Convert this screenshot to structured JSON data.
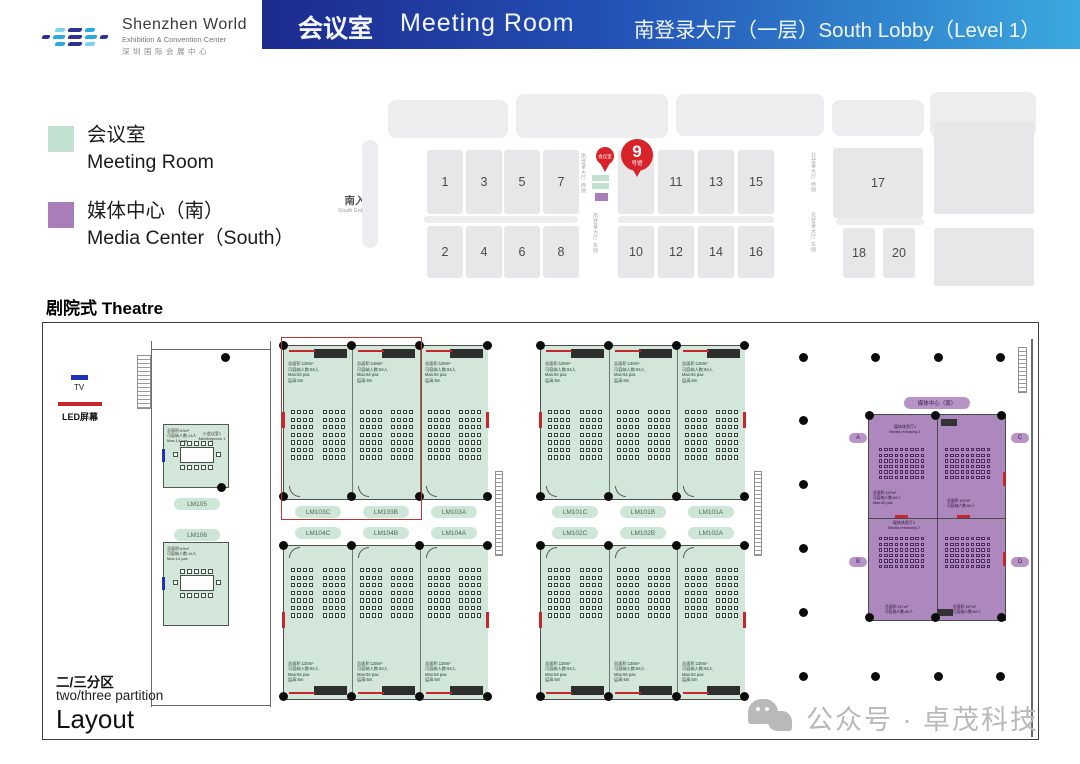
{
  "header": {
    "logo": {
      "title": "Shenzhen World",
      "subtitle": "Exhibition & Convention Center",
      "cn": "深圳国际会展中心"
    },
    "title_cn": "会议室",
    "title_en": "Meeting Room",
    "location": "南登录大厅（一层）South Lobby（Level 1）",
    "gradient_from": "#1d2a8e",
    "gradient_to": "#3ba9df"
  },
  "legend": {
    "items": [
      {
        "label_cn": "会议室",
        "label_en": "Meeting Room",
        "color": "#c3e1d0"
      },
      {
        "label_cn": "媒体中心（南）",
        "label_en": "Media Center（South）",
        "color": "#a87db9"
      }
    ]
  },
  "overview": {
    "south_entrance_cn": "南入口",
    "south_entrance_en": "South Entrance",
    "pin_small_label": "会议室",
    "pin_big_number": "9",
    "pin_big_suffix": "号馆",
    "pin_color": "#d8232a",
    "vertical_labels": {
      "south_west": "南登录大厅 西侧",
      "south_east": "南登录大厅 东侧",
      "north_west": "北登录大厅 西侧",
      "north_east": "北登录大厅 东侧"
    },
    "halls": [
      {
        "label": "1",
        "x": 427,
        "y": 150,
        "w": 36,
        "h": 64
      },
      {
        "label": "3",
        "x": 466,
        "y": 150,
        "w": 36,
        "h": 64
      },
      {
        "label": "5",
        "x": 504,
        "y": 150,
        "w": 36,
        "h": 64
      },
      {
        "label": "7",
        "x": 543,
        "y": 150,
        "w": 36,
        "h": 64
      },
      {
        "label": "",
        "x": 618,
        "y": 150,
        "w": 36,
        "h": 64
      },
      {
        "label": "11",
        "x": 658,
        "y": 150,
        "w": 36,
        "h": 64
      },
      {
        "label": "13",
        "x": 698,
        "y": 150,
        "w": 36,
        "h": 64
      },
      {
        "label": "15",
        "x": 738,
        "y": 150,
        "w": 36,
        "h": 64
      },
      {
        "label": "17",
        "x": 833,
        "y": 148,
        "w": 90,
        "h": 70
      },
      {
        "label": "2",
        "x": 427,
        "y": 226,
        "w": 36,
        "h": 52
      },
      {
        "label": "4",
        "x": 466,
        "y": 226,
        "w": 36,
        "h": 52
      },
      {
        "label": "6",
        "x": 504,
        "y": 226,
        "w": 36,
        "h": 52
      },
      {
        "label": "8",
        "x": 543,
        "y": 226,
        "w": 36,
        "h": 52
      },
      {
        "label": "10",
        "x": 618,
        "y": 226,
        "w": 36,
        "h": 52
      },
      {
        "label": "12",
        "x": 658,
        "y": 226,
        "w": 36,
        "h": 52
      },
      {
        "label": "14",
        "x": 698,
        "y": 226,
        "w": 36,
        "h": 52
      },
      {
        "label": "16",
        "x": 738,
        "y": 226,
        "w": 36,
        "h": 52
      },
      {
        "label": "18",
        "x": 843,
        "y": 228,
        "w": 32,
        "h": 50
      },
      {
        "label": "20",
        "x": 883,
        "y": 228,
        "w": 32,
        "h": 50
      },
      {
        "label": "",
        "x": 934,
        "y": 122,
        "w": 100,
        "h": 92
      },
      {
        "label": "",
        "x": 934,
        "y": 228,
        "w": 100,
        "h": 58
      }
    ]
  },
  "plan": {
    "title": "剧院式 Theatre",
    "tv_label": "TV",
    "led_label": "LED屏幕",
    "partition_cn": "二/三分区",
    "partition_en": "two/three partition",
    "layout_label": "Layout",
    "theatre_spec": [
      "总面积:138m²",
      "可容纳人数:64人",
      "Max:64 pax",
      "层高:6m"
    ],
    "boardroom": {
      "name_cn": "小会议室1",
      "name_en": "Meetingroom 1",
      "spec": [
        "总面积:63m²",
        "可容纳人数:14人",
        "Max:14 pax"
      ]
    },
    "left_room_labels": [
      "LM105",
      "LM106"
    ],
    "blocks": [
      {
        "labels": [
          "LM103C",
          "LM103B",
          "LM103A"
        ],
        "x": 283,
        "y": 345,
        "orient": "top"
      },
      {
        "labels": [
          "LM104C",
          "LM104B",
          "LM104A"
        ],
        "x": 283,
        "y": 545,
        "orient": "bottom"
      },
      {
        "labels": [
          "LM101C",
          "LM101B",
          "LM101A"
        ],
        "x": 540,
        "y": 345,
        "orient": "top"
      },
      {
        "labels": [
          "LM102C",
          "LM102B",
          "LM102A"
        ],
        "x": 540,
        "y": 545,
        "orient": "bottom"
      }
    ],
    "media_center": {
      "label": "媒体中心（南）",
      "zone_labels": [
        "A",
        "C",
        "B",
        "D"
      ],
      "room1_cn": "媒体休息厅1",
      "room1_en": "Media releasing 1",
      "room2_cn": "媒体休息厅2",
      "room2_en": "Media releasing 2",
      "spec": [
        "总面积:157m²",
        "可容纳人数:60人",
        "Max:60 pax"
      ]
    }
  },
  "watermark": {
    "text": "公众号 · 卓茂科技"
  }
}
